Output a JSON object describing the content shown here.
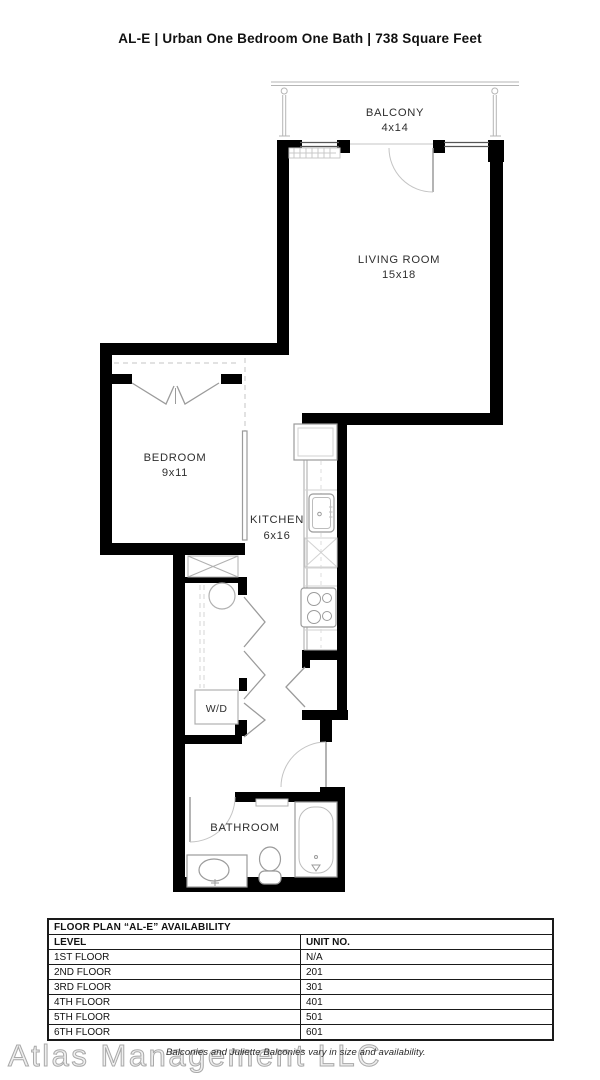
{
  "header": {
    "title": "AL-E | Urban One Bedroom One Bath | 738 Square Feet"
  },
  "floor_plan": {
    "balcony": {
      "label": "BALCONY",
      "dims": "4x14"
    },
    "living_room": {
      "label": "LIVING ROOM",
      "dims": "15x18"
    },
    "bedroom": {
      "label": "BEDROOM",
      "dims": "9x11"
    },
    "kitchen": {
      "label": "KITCHEN",
      "dims": "6x16"
    },
    "washer_dryer": {
      "label": "W/D"
    },
    "bathroom": {
      "label": "BATHROOM"
    }
  },
  "availability_table": {
    "title": "FLOOR PLAN “AL-E” AVAILABILITY",
    "columns": {
      "level": "LEVEL",
      "unit": "UNIT NO."
    },
    "rows": [
      {
        "level": "1ST FLOOR",
        "unit": "N/A"
      },
      {
        "level": "2ND FLOOR",
        "unit": "201"
      },
      {
        "level": "3RD FLOOR",
        "unit": "301"
      },
      {
        "level": "4TH FLOOR",
        "unit": "401"
      },
      {
        "level": "5TH FLOOR",
        "unit": "501"
      },
      {
        "level": "6TH FLOOR",
        "unit": "601"
      }
    ]
  },
  "footer": {
    "watermark": "Atlas Management LLC",
    "disclaimer": "Balconies and Juliette Balconies vary in size and availability."
  },
  "colors": {
    "wall": "#000000",
    "fixture_outline": "#9b9b9b",
    "light_line": "#c4c4c4",
    "table_border": "#1a1a1a",
    "background": "#ffffff"
  }
}
